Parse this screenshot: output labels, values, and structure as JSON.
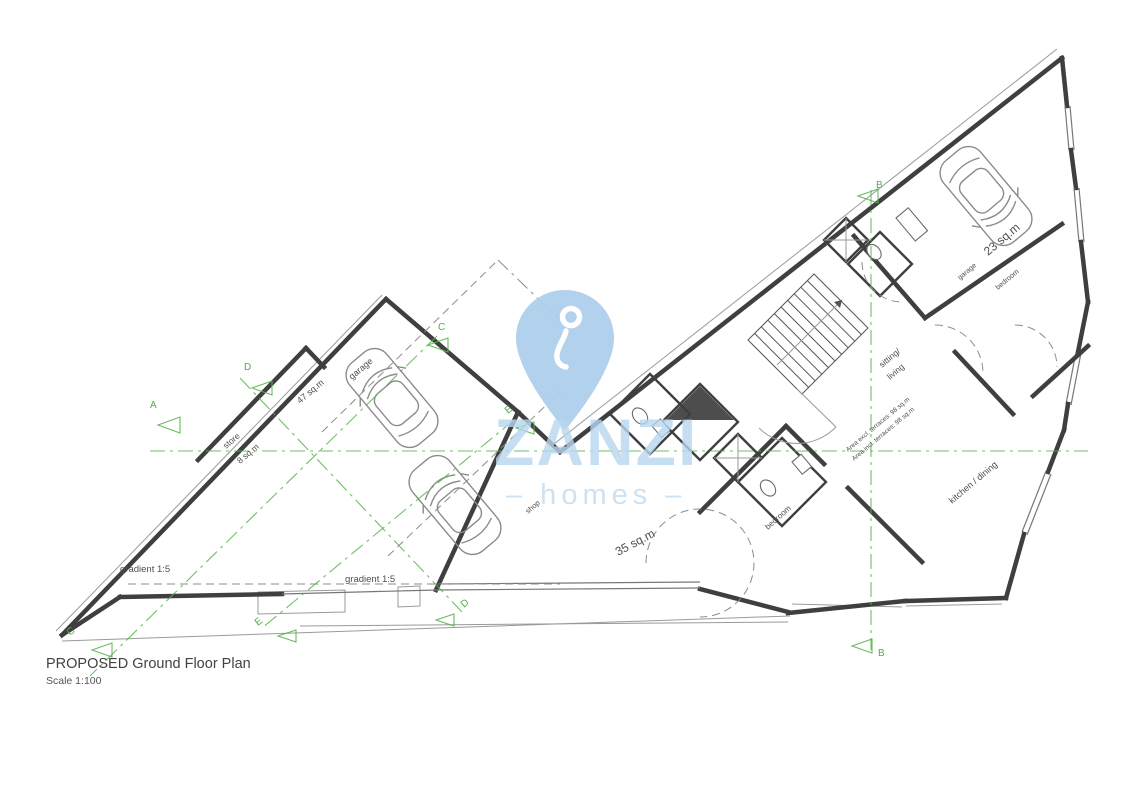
{
  "page": {
    "background": "#ffffff"
  },
  "title_block": {
    "heading": "PROPOSED Ground Floor Plan",
    "scale": "Scale 1:100"
  },
  "watermark": {
    "brand": "ZANZI",
    "tagline": "– homes –",
    "pin_color": "#aecfec",
    "text_color": "#b9d6ef"
  },
  "colors": {
    "wall": "#3f3f3f",
    "thin_line": "#9a9a9a",
    "dashed_line": "#8c8c8c",
    "section_green": "#58b44e",
    "lift_fill": "#4d4d4d",
    "label": "#4f4f4f"
  },
  "rooms": {
    "store": {
      "name": "store",
      "area": "8 sq.m"
    },
    "garage_left": {
      "name": "garage",
      "area": "47 sq.m"
    },
    "shop": {
      "name": "shop",
      "area": "35 sq.m"
    },
    "bedroom_mid": {
      "name": "bedroom"
    },
    "sitting_living": {
      "line1": "sitting/",
      "line2": "living"
    },
    "kitchen_dining": {
      "name": "kitchen / dining"
    },
    "garage_right": {
      "name": "garage",
      "area": "23 sq.m"
    },
    "bedroom_right": {
      "name": "bedroom"
    }
  },
  "annotations": {
    "gradient_left": "gradient 1:5",
    "gradient_mid": "gradient 1:5",
    "area_excl": "Area excl. terraces: 98 sq.m",
    "area_incl": "Area incl. terraces: 98 sq.m"
  },
  "section_markers": {
    "a": "A",
    "b_top": "B",
    "b_bottom": "B",
    "c_top": "C",
    "c_bottom": "C",
    "d_top": "D",
    "d_bottom": "D",
    "e_mid": "E",
    "e_bottom": "E"
  }
}
